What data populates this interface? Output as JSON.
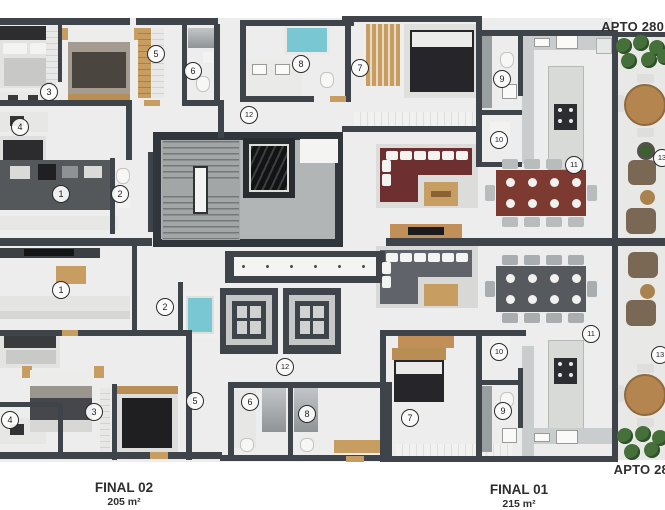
{
  "plan": {
    "apto_label_top": "APTO 280",
    "apto_label_bottom": "APTO 28",
    "units": [
      {
        "id": "final-02",
        "name": "FINAL 02",
        "area": "205 m²"
      },
      {
        "id": "final-01",
        "name": "FINAL 01",
        "area": "215 m²"
      }
    ],
    "room_markers": [
      {
        "label": "3",
        "x": 48,
        "y": 91
      },
      {
        "label": "4",
        "x": 19,
        "y": 126
      },
      {
        "label": "5",
        "x": 155,
        "y": 53
      },
      {
        "label": "6",
        "x": 192,
        "y": 70
      },
      {
        "label": "8",
        "x": 300,
        "y": 63
      },
      {
        "label": "7",
        "x": 359,
        "y": 67
      },
      {
        "label": "12",
        "x": 248,
        "y": 114
      },
      {
        "label": "9",
        "x": 501,
        "y": 78
      },
      {
        "label": "10",
        "x": 498,
        "y": 139
      },
      {
        "label": "11",
        "x": 573,
        "y": 164
      },
      {
        "label": "13",
        "x": 661,
        "y": 157
      },
      {
        "label": "1",
        "x": 60,
        "y": 193
      },
      {
        "label": "2",
        "x": 119,
        "y": 193
      },
      {
        "label": "1",
        "x": 60,
        "y": 289
      },
      {
        "label": "2",
        "x": 164,
        "y": 306
      },
      {
        "label": "12",
        "x": 284,
        "y": 366
      },
      {
        "label": "11",
        "x": 590,
        "y": 333
      },
      {
        "label": "13",
        "x": 659,
        "y": 354
      },
      {
        "label": "10",
        "x": 498,
        "y": 351
      },
      {
        "label": "4",
        "x": 9,
        "y": 419
      },
      {
        "label": "3",
        "x": 93,
        "y": 411
      },
      {
        "label": "5",
        "x": 194,
        "y": 400
      },
      {
        "label": "6",
        "x": 249,
        "y": 401
      },
      {
        "label": "8",
        "x": 306,
        "y": 413
      },
      {
        "label": "7",
        "x": 409,
        "y": 417
      },
      {
        "label": "9",
        "x": 502,
        "y": 410
      }
    ],
    "colors": {
      "wall": "#3f444a",
      "floor": "#ecedec",
      "core_floor": "#b1b5b5",
      "water": "#79c7d3",
      "wood": "#c79d62",
      "sofa_red": "#6d2f2f",
      "sofa_gray": "#60646a",
      "plant_green": "#46703a"
    }
  }
}
